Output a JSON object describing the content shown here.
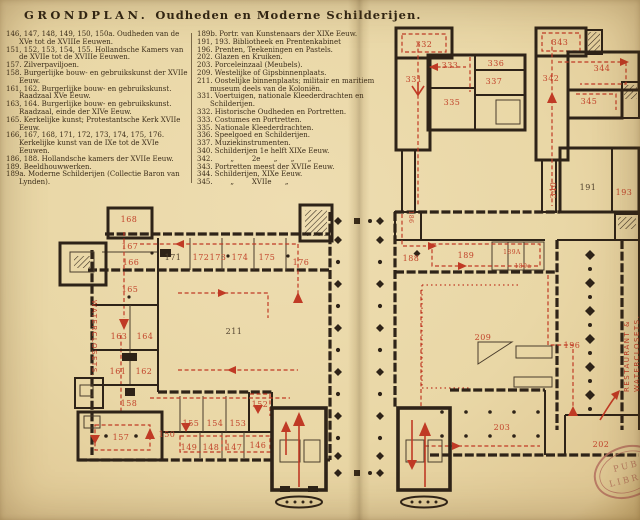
{
  "title": {
    "main": "GRONDPLAN.",
    "sub": "Oudheden en Moderne Schilderijen."
  },
  "legend": {
    "left": [
      "146, 147, 148, 149, 150, 150a. Oudheden van de XVe tot de XVIIIe Eeuwen.",
      "151, 152, 153, 154, 155. Hollandsche Kamers van de XVIIe tot de XVIIIe Eeuwen.",
      "157. Zilverpaviljoen.",
      "158. Burgerlijke bouw- en gebruikskunst der XVIIe Eeuw.",
      "161, 162. Burgerlijke bouw- en gebruikskunst. Raadzaal XVe Eeuw.",
      "163, 164. Burgerlijke bouw- en gebruikskunst. Raadzaal, einde der XIVe Eeuw.",
      "165. Kerkelijke kunst; Protestantsche Kerk XVIIe Eeuw.",
      "166, 167, 168, 171, 172, 173, 174, 175, 176. Kerkelijke kunst van de IXe tot de XVIe Eeuwen.",
      "186, 188. Hollandsche kamers der XVIIe Eeuw.",
      "189. Beeldhouwwerken.",
      "189a. Moderne Schilderijen (Collectie Baron van Lynden)."
    ],
    "right": [
      "189b. Portr. van Kunstenaars der XIXe Eeuw.",
      "191, 193. Bibliotheek en Prentenkabinet",
      "196. Prenten, Teekeningen en Pastels.",
      "202. Glazen en Kruiken.",
      "203. Porceleinzaal (Meubels).",
      "209. Westelijke of Gipsbinnenplaats.",
      "211. Oostelijke binnenplaats; militair en maritiem museum deels van de Koloniën.",
      "331. Voertuigen, nationale Kleederdrachten en Schilderijen.",
      "332. Historische Oudheden en Portretten.",
      "333. Costumes en Portretten.",
      "335. Nationale Kleederdrachten.",
      "336. Speelgoed en Schilderijen.",
      "337. Muziekinstrumenten.",
      "340. Schilderijen 1e helft XIXe Eeuw.",
      "342.        „        2e      „      „      „",
      "343. Portretten meest der XVIIe Eeuw.",
      "344. Schilderijen, XIXe Eeuw.",
      "345.        „        XVIIe      „"
    ]
  },
  "plan": {
    "rooms": {
      "r146": "146",
      "r147": "147",
      "r148": "148",
      "r149": "149",
      "r150": "150",
      "r152": "152",
      "r153": "153",
      "r154": "154",
      "r155": "155",
      "r157": "157",
      "r158": "158",
      "r161": "161",
      "r162": "162",
      "r163": "163",
      "r164": "164",
      "r165": "165",
      "r166": "166",
      "r167": "167",
      "r168": "168",
      "r171": "171",
      "r172": "172",
      "r173": "173",
      "r174": "174",
      "r175": "175",
      "r176": "176",
      "r186": "186",
      "r188": "188",
      "r189": "189",
      "r189A": "189A",
      "r189a": "189a",
      "r191": "191",
      "r193": "193",
      "r196": "196",
      "r202": "202",
      "r203": "203",
      "r209": "209",
      "r211": "211",
      "r331": "331",
      "r332": "332",
      "r333": "333",
      "r335": "335",
      "r336": "336",
      "r337": "337",
      "r340": "340",
      "r342": "342",
      "r343": "343",
      "r344": "344",
      "r345": "345"
    },
    "side_left": "WATERCLOSETS.",
    "side_right_1": "RESTAURANT &",
    "side_right_2": "WATERCLOSETS.",
    "stamp_line1": "PUB",
    "stamp_line2": "LIBR"
  },
  "colors": {
    "paper": "#e9d7a6",
    "ink": "#2e2318",
    "red": "#c03a25",
    "stamp": "#a8604f"
  }
}
